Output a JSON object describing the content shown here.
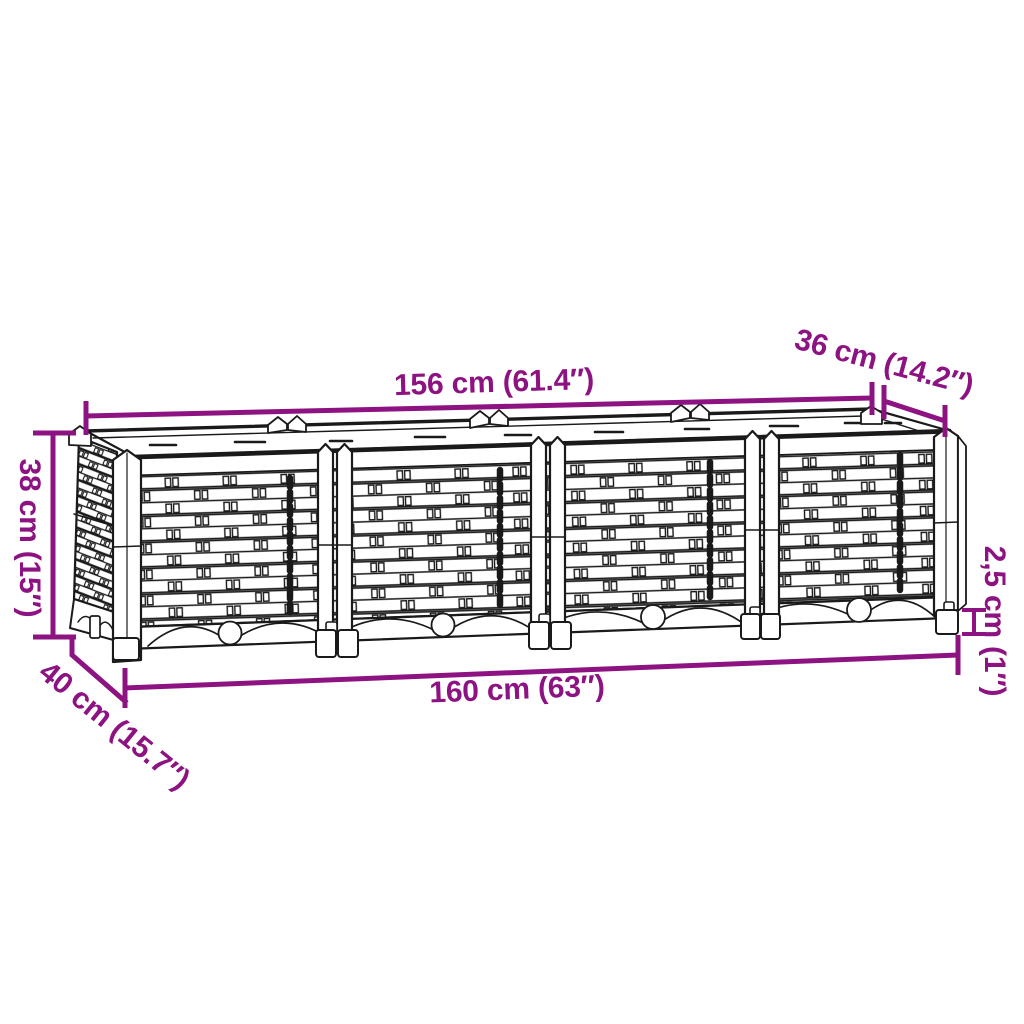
{
  "page": {
    "type": "product dimension diagram",
    "product": "rattan-look raised garden bed planter, 4 woven sections with corner posts and feet",
    "background": "#ffffff"
  },
  "colors": {
    "dimension_accent": "#8e1382",
    "line_art": "#1a1a1a",
    "background": "#ffffff"
  },
  "dimension_labels": {
    "top_width": {
      "label": "156 cm (61.4″)",
      "value_cm": "156 cm",
      "value_in": "61.4″"
    },
    "top_depth": {
      "label": "36 cm (14.2″)",
      "value_cm": "36 cm",
      "value_in": "14.2″"
    },
    "height": {
      "label": "38 cm (15″)",
      "value_cm": "38 cm",
      "value_in": "15″"
    },
    "base_depth": {
      "label": "40 cm (15.7″)",
      "value_cm": "40 cm",
      "value_in": "15.7″"
    },
    "base_width": {
      "label": "160 cm (63″)",
      "value_cm": "160 cm",
      "value_in": "63″"
    },
    "foot_height": {
      "label": "2,5 cm (1″)",
      "value_cm": "2,5 cm",
      "value_in": "1″"
    }
  }
}
